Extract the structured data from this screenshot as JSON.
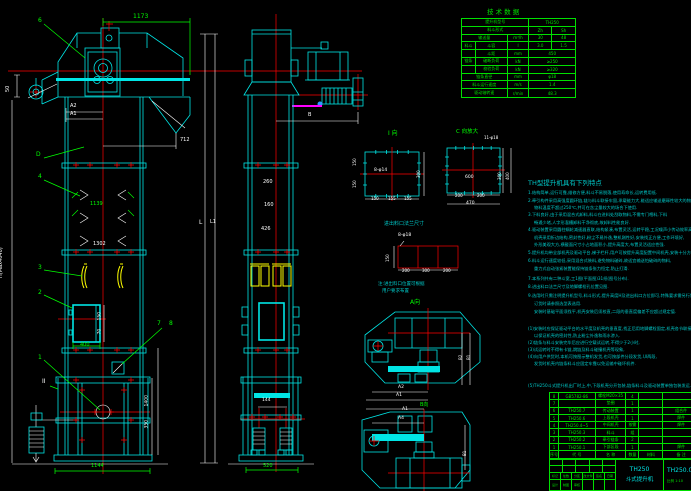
{
  "app": {
    "type": "cad-drawing",
    "background": "#000000"
  },
  "colors": {
    "line": "#00E5E5",
    "dim_green": "#00FF00",
    "dim_white": "#FFFFFF",
    "center": "#FF0000",
    "bucket": "#FFFF00",
    "note": "#00C8C8",
    "grid": "#00E000"
  },
  "tech_table": {
    "title": "技 术 数 据",
    "rows": [
      [
        {
          "t": "提升机型号",
          "w": 68
        },
        {
          "t": "TH250",
          "w": 46
        }
      ],
      [
        {
          "t": "料斗形式",
          "w": 68
        },
        {
          "t": "Zh",
          "w": 23
        },
        {
          "t": "Sh",
          "w": 23
        }
      ],
      [
        {
          "t": "输送量",
          "w": 46
        },
        {
          "t": "m³/h",
          "w": 22
        },
        {
          "t": "30",
          "w": 23
        },
        {
          "t": "48",
          "w": 23
        }
      ],
      [
        {
          "t": "料斗",
          "w": 14
        },
        {
          "t": "斗容",
          "w": 32
        },
        {
          "t": "l",
          "w": 22
        },
        {
          "t": "3.0",
          "w": 23
        },
        {
          "t": "1.5",
          "w": 23
        }
      ],
      [
        {
          "t": "",
          "w": 14
        },
        {
          "t": "斗距",
          "w": 32
        },
        {
          "t": "mm",
          "w": 22
        },
        {
          "t": "450",
          "w": 46
        }
      ],
      [
        {
          "t": "链条",
          "w": 14
        },
        {
          "t": "破断负荷",
          "w": 32
        },
        {
          "t": "kN",
          "w": 22
        },
        {
          "t": "≥250",
          "w": 46
        }
      ],
      [
        {
          "t": "",
          "w": 14
        },
        {
          "t": "校验负荷",
          "w": 32
        },
        {
          "t": "kN",
          "w": 22
        },
        {
          "t": "≥320",
          "w": 46
        }
      ],
      [
        {
          "t": "链条直径",
          "w": 46
        },
        {
          "t": "mm",
          "w": 22
        },
        {
          "t": "φ18",
          "w": 46
        }
      ],
      [
        {
          "t": "料斗运行速度",
          "w": 46
        },
        {
          "t": "m/s",
          "w": 22
        },
        {
          "t": "1.4",
          "w": 46
        }
      ],
      [
        {
          "t": "驱动轴转速",
          "w": 46
        },
        {
          "t": "r/min",
          "w": 22
        },
        {
          "t": "48.3",
          "w": 46
        }
      ]
    ]
  },
  "parts_list": {
    "col_widths": [
      9,
      37,
      31,
      13,
      24,
      36
    ],
    "rows": [
      [
        "8",
        "GB5782-86",
        "螺栓M20×35",
        "4",
        "",
        ""
      ],
      [
        "7",
        "",
        "垫圈",
        "1",
        "",
        ""
      ],
      [
        "6",
        "TH250.7",
        "传动装置",
        "1",
        "",
        "组合件"
      ],
      [
        "5",
        "TH250.6",
        "上段机壳",
        "1",
        "",
        "焊件"
      ],
      [
        "4",
        "TH250.4~5",
        "中间机壳",
        "按需",
        "",
        "焊件"
      ],
      [
        "3",
        "TH250.3",
        "料斗",
        "组",
        "",
        ""
      ],
      [
        "2",
        "TH250.2",
        "牵引链条",
        "2",
        "",
        ""
      ],
      [
        "1",
        "TH250.1",
        "下部区段",
        "1",
        "",
        "焊件"
      ],
      [
        "序号",
        "代  号",
        "名  称",
        "数量",
        "材料",
        "备  注"
      ]
    ]
  },
  "title_block": {
    "model": "TH250",
    "name": "斗式提升机",
    "drawing_no": "TH250.0",
    "scale": "比例 1:10",
    "sig_labels": [
      "标记",
      "处数",
      "分区",
      "更改文件号",
      "签名",
      "日期"
    ],
    "bottom_labels": [
      "设计",
      "制图",
      "审核"
    ]
  },
  "features": {
    "heading": {
      "t": "TH型提升机具有下列特点",
      "x": 528,
      "y": 180
    },
    "lines": [
      {
        "x": 528,
        "y": 191,
        "t": "1.结构简单,运行可靠,维修方便,料斗不易脱落,使用寿命长,运转费用低."
      },
      {
        "x": 528,
        "y": 199,
        "t": "2.牵引构件采用高强度圆环链,链与料斗联接牢固,承载能力大,能适应输送磨琢性较大的物料,"
      },
      {
        "x": 534,
        "y": 206,
        "t": "物料温度不超过250℃,并可在含尘量较大的场合下使用."
      },
      {
        "x": 528,
        "y": 213,
        "t": "3.下料良好,由于采用混合式卸料,料斗在进料处刮取物料,不需专门喂料,下料"
      },
      {
        "x": 534,
        "y": 221,
        "t": "畅通少堵,人字形溜槽卸料干净彻底,故卸料性能良好."
      },
      {
        "x": 528,
        "y": 228,
        "t": "4.驱动装置采用圆柱蜗轮减速器直联,结构紧凑,布置灵活,运转平稳,工况噪声小传动效率高,"
      },
      {
        "x": 534,
        "y": 236,
        "t": "机壳采用折边结构,密封性好,粉尘不易外逸,整机刚性好,安装找正方便,工作环境好,"
      },
      {
        "x": 534,
        "y": 243,
        "t": "外形美观大方,横截面尺寸小占地面积小,提升高度大,布置灵活适应性强."
      },
      {
        "x": 528,
        "y": 251,
        "t": "5.提升机均带全部机壳及驱动平台,梯子栏杆,用户可按提升高度配置中间机壳,安装十分方便."
      },
      {
        "x": 528,
        "y": 259,
        "t": "6.料斗运行速度较低,采用混合式装料,避免物料破碎,故适宜输送怕破碎的物料,"
      },
      {
        "x": 534,
        "y": 267,
        "t": "重力式自动张紧装置能保持链条张力恒定,防止打滑."
      },
      {
        "x": 528,
        "y": 277,
        "t": "7.本系列共有二种斗宽,工1图(平面图)31纸(图号分布)."
      },
      {
        "x": 528,
        "y": 285,
        "t": "8.进出料口法兰尺寸及地脚螺栓孔位置见图."
      },
      {
        "x": 528,
        "y": 294,
        "t": "9.选用时只需注明提升机型号,料斗形式,提升高度H及进出料口方位即可,特殊要求需另行协商确定,"
      },
      {
        "x": 534,
        "y": 302,
        "t": "订货时请参照选型表选用."
      },
      {
        "x": 534,
        "y": 310,
        "t": "安装时基础平面须找平,机壳安装后须校直,二段的垂直度偏差不应超过规定值."
      },
      {
        "x": 528,
        "y": 327,
        "t": "(1)安装时应保证驱动平台的水平度及机壳的垂直度,找正后用地脚螺栓固定,机壳各节联接处加密封垫,"
      },
      {
        "x": 534,
        "y": 334,
        "t": "以保证机壳的密封性,防止粉尘外逸和雨水渗入."
      },
      {
        "x": 528,
        "y": 341,
        "t": "(2)链条与料斗安装完毕后应进行空载试运转,不得少于2小时,"
      },
      {
        "x": 528,
        "y": 348,
        "t": "(3)试运转时不得有卡链,跳链及料斗碰撞机壳等现象,"
      },
      {
        "x": 528,
        "y": 355,
        "t": "(4)向用户供货时,本机可按图示整机发货,也可按部件分段发货,Ⅰ,Ⅱ两段,"
      },
      {
        "x": 534,
        "y": 362,
        "t": "发货时机壳内链条料斗应固定牢靠以免运输中碰坏机件."
      },
      {
        "x": 528,
        "y": 384,
        "t": "(5)TH250斗式提升机出厂时上,中,下段机壳分开包装,链条料斗及驱动装置单独包装发运."
      }
    ]
  },
  "annotations": [
    {
      "t": "1173",
      "x": 133,
      "y": 14,
      "c": "#00FF00",
      "s": 6,
      "n": "dim-1173"
    },
    {
      "t": "50",
      "x": 11,
      "y": 92,
      "c": "#FFFFFF",
      "s": 5,
      "r": -90,
      "n": "dim-50"
    },
    {
      "t": "A2",
      "x": 70,
      "y": 104,
      "c": "#FFFFFF",
      "s": 5,
      "n": "dim-a2"
    },
    {
      "t": "A1",
      "x": 70,
      "y": 112,
      "c": "#FFFFFF",
      "s": 5,
      "n": "dim-a1"
    },
    {
      "t": "712",
      "x": 180,
      "y": 138,
      "c": "#FFFFFF",
      "s": 5,
      "n": "dim-712"
    },
    {
      "t": "6",
      "x": 38,
      "y": 18,
      "c": "#00FF00",
      "s": 6,
      "n": "item-6"
    },
    {
      "t": "D",
      "x": 36,
      "y": 152,
      "c": "#00FF00",
      "s": 6,
      "n": "label-d"
    },
    {
      "t": "4",
      "x": 38,
      "y": 174,
      "c": "#00FF00",
      "s": 6,
      "n": "item-4"
    },
    {
      "t": "3",
      "x": 38,
      "y": 265,
      "c": "#00FF00",
      "s": 6,
      "n": "item-3"
    },
    {
      "t": "2",
      "x": 38,
      "y": 290,
      "c": "#00FF00",
      "s": 6,
      "n": "item-2"
    },
    {
      "t": "1",
      "x": 38,
      "y": 355,
      "c": "#00FF00",
      "s": 6,
      "n": "item-1"
    },
    {
      "t": "7",
      "x": 157,
      "y": 321,
      "c": "#00FF00",
      "s": 6,
      "n": "item-7"
    },
    {
      "t": "8",
      "x": 169,
      "y": 321,
      "c": "#00FF00",
      "s": 6,
      "n": "item-8"
    },
    {
      "t": "II",
      "x": 42,
      "y": 379,
      "c": "#FFFFFF",
      "s": 6,
      "n": "section-ii"
    },
    {
      "t": "1139",
      "x": 90,
      "y": 202,
      "c": "#00FF00",
      "s": 5,
      "n": "dim-1139"
    },
    {
      "t": "1302",
      "x": 93,
      "y": 242,
      "c": "#FFFFFF",
      "s": 5,
      "n": "dim-1302"
    },
    {
      "t": "400",
      "x": 80,
      "y": 343,
      "c": "#00FF00",
      "s": 5,
      "n": "dim-400"
    },
    {
      "t": "150",
      "x": 103,
      "y": 320,
      "c": "#FFFFFF",
      "s": 4.5,
      "r": -90,
      "n": "dim-150-door"
    },
    {
      "t": "70",
      "x": 103,
      "y": 334,
      "c": "#FFFFFF",
      "s": 4.5,
      "r": -90,
      "n": "dim-70-door"
    },
    {
      "t": "1400",
      "x": 150,
      "y": 406,
      "c": "#FFFFFF",
      "s": 4.5,
      "r": -90,
      "n": "dim-1400"
    },
    {
      "t": "350",
      "x": 150,
      "y": 428,
      "c": "#FFFFFF",
      "s": 4.5,
      "r": -90,
      "n": "dim-350"
    },
    {
      "t": "1144",
      "x": 91,
      "y": 464,
      "c": "#00FF00",
      "s": 5,
      "n": "dim-1144"
    },
    {
      "t": "H(Max4040)",
      "x": 4,
      "y": 278,
      "c": "#FFFFFF",
      "s": 5,
      "r": -90,
      "n": "dim-h-max"
    },
    {
      "t": "L",
      "x": 199,
      "y": 220,
      "c": "#FFFFFF",
      "s": 6,
      "n": "dim-l"
    },
    {
      "t": "L1",
      "x": 210,
      "y": 220,
      "c": "#FFFFFF",
      "s": 5,
      "n": "dim-l1"
    },
    {
      "t": "B",
      "x": 308,
      "y": 113,
      "c": "#FFFFFF",
      "s": 5,
      "n": "dim-b"
    },
    {
      "t": "260",
      "x": 263,
      "y": 180,
      "c": "#FFFFFF",
      "s": 5,
      "n": "dim-260"
    },
    {
      "t": "160",
      "x": 264,
      "y": 203,
      "c": "#FFFFFF",
      "s": 5,
      "n": "dim-160"
    },
    {
      "t": "426",
      "x": 261,
      "y": 227,
      "c": "#FFFFFF",
      "s": 5,
      "n": "dim-426"
    },
    {
      "t": "144",
      "x": 262,
      "y": 399,
      "c": "#FFFFFF",
      "s": 4.5,
      "n": "dim-144"
    },
    {
      "t": "520",
      "x": 263,
      "y": 464,
      "c": "#00FF00",
      "s": 5,
      "n": "dim-520"
    },
    {
      "t": "I 向",
      "x": 388,
      "y": 131,
      "c": "#00FF00",
      "s": 6,
      "n": "view-label-i"
    },
    {
      "t": "8-φ14",
      "x": 374,
      "y": 169,
      "c": "#FFFFFF",
      "s": 4.5,
      "n": "flange-i-holes"
    },
    {
      "t": "150",
      "x": 357,
      "y": 166,
      "c": "#FFFFFF",
      "s": 4,
      "r": -90,
      "n": "flange-i-dim"
    },
    {
      "t": "150",
      "x": 357,
      "y": 188,
      "c": "#FFFFFF",
      "s": 4,
      "r": -90,
      "n": "flange-i-dim"
    },
    {
      "t": "300",
      "x": 421,
      "y": 178,
      "c": "#FFFFFF",
      "s": 4,
      "r": -90,
      "n": "flange-i-dim"
    },
    {
      "t": "150",
      "x": 371,
      "y": 197,
      "c": "#FFFFFF",
      "s": 4,
      "n": "flange-i-dim"
    },
    {
      "t": "155",
      "x": 388,
      "y": 197,
      "c": "#FFFFFF",
      "s": 4,
      "n": "flange-i-dim"
    },
    {
      "t": "155",
      "x": 404,
      "y": 197,
      "c": "#FFFFFF",
      "s": 4,
      "n": "flange-i-dim"
    },
    {
      "t": "C 向放大",
      "x": 456,
      "y": 130,
      "c": "#00FF00",
      "s": 5.5,
      "n": "view-label-c"
    },
    {
      "t": "11-φ18",
      "x": 484,
      "y": 136,
      "c": "#FFFFFF",
      "s": 4,
      "n": "flange-c-holes"
    },
    {
      "t": "600",
      "x": 465,
      "y": 176,
      "c": "#FFFFFF",
      "s": 4.5,
      "n": "flange-c-dim"
    },
    {
      "t": "200",
      "x": 455,
      "y": 194,
      "c": "#FFFFFF",
      "s": 4,
      "n": "flange-c-dim"
    },
    {
      "t": "200",
      "x": 477,
      "y": 194,
      "c": "#FFFFFF",
      "s": 4,
      "n": "flange-c-dim"
    },
    {
      "t": "470",
      "x": 466,
      "y": 202,
      "c": "#FFFFFF",
      "s": 4.5,
      "n": "flange-c-dim"
    },
    {
      "t": "360",
      "x": 502,
      "y": 180,
      "c": "#FFFFFF",
      "s": 4,
      "r": -90,
      "n": "flange-c-dim"
    },
    {
      "t": "400",
      "x": 510,
      "y": 180,
      "c": "#FFFFFF",
      "s": 4,
      "r": -90,
      "n": "flange-c-dim"
    },
    {
      "t": "进出料口法兰尺寸",
      "x": 384,
      "y": 222,
      "c": "#00C8C8",
      "s": 5,
      "n": "flange-caption"
    },
    {
      "t": "8-φ18",
      "x": 398,
      "y": 234,
      "c": "#FFFFFF",
      "s": 4.5,
      "n": "inlet-holes"
    },
    {
      "t": "150",
      "x": 390,
      "y": 262,
      "c": "#FFFFFF",
      "s": 4,
      "r": -90,
      "n": "inlet-dim"
    },
    {
      "t": "200",
      "x": 402,
      "y": 269,
      "c": "#FFFFFF",
      "s": 4,
      "n": "inlet-dim"
    },
    {
      "t": "300",
      "x": 422,
      "y": 269,
      "c": "#FFFFFF",
      "s": 4,
      "n": "inlet-dim"
    },
    {
      "t": "200",
      "x": 443,
      "y": 269,
      "c": "#FFFFFF",
      "s": 4,
      "n": "inlet-dim"
    },
    {
      "t": "注:进出料口位置可根据",
      "x": 378,
      "y": 283,
      "c": "#00C8C8",
      "s": 4.5,
      "n": "inlet-note"
    },
    {
      "t": "用户要求布置",
      "x": 382,
      "y": 290,
      "c": "#00C8C8",
      "s": 4.5,
      "n": "inlet-note"
    },
    {
      "t": "A向",
      "x": 410,
      "y": 300,
      "c": "#00FF00",
      "s": 6,
      "n": "view-label-a"
    },
    {
      "t": "A2",
      "x": 398,
      "y": 386,
      "c": "#FFFFFF",
      "s": 4.5,
      "n": "view-a-dim"
    },
    {
      "t": "A1",
      "x": 396,
      "y": 394,
      "c": "#FFFFFF",
      "s": 4.5,
      "n": "view-a-dim"
    },
    {
      "t": "B2",
      "x": 463,
      "y": 360,
      "c": "#FFFFFF",
      "s": 4,
      "r": -90,
      "n": "view-a-dim"
    },
    {
      "t": "B1",
      "x": 471,
      "y": 360,
      "c": "#FFFFFF",
      "s": 4,
      "r": -90,
      "n": "view-a-dim"
    },
    {
      "t": "B向",
      "x": 420,
      "y": 403,
      "c": "#00FF00",
      "s": 5,
      "n": "view-label-b"
    },
    {
      "t": "A1",
      "x": 402,
      "y": 408,
      "c": "#FFFFFF",
      "s": 4.5,
      "n": "view-b-dim"
    },
    {
      "t": "A4",
      "x": 398,
      "y": 417,
      "c": "#FFFFFF",
      "s": 4.5,
      "n": "view-b-dim"
    },
    {
      "t": "B1",
      "x": 467,
      "y": 456,
      "c": "#FFFFFF",
      "s": 4,
      "r": -90,
      "n": "view-b-dim"
    },
    {
      "t": "技 术 数 据",
      "x": 487,
      "y": 9,
      "c": "#00E000",
      "s": 6.5,
      "n": "tech-table-title"
    }
  ]
}
